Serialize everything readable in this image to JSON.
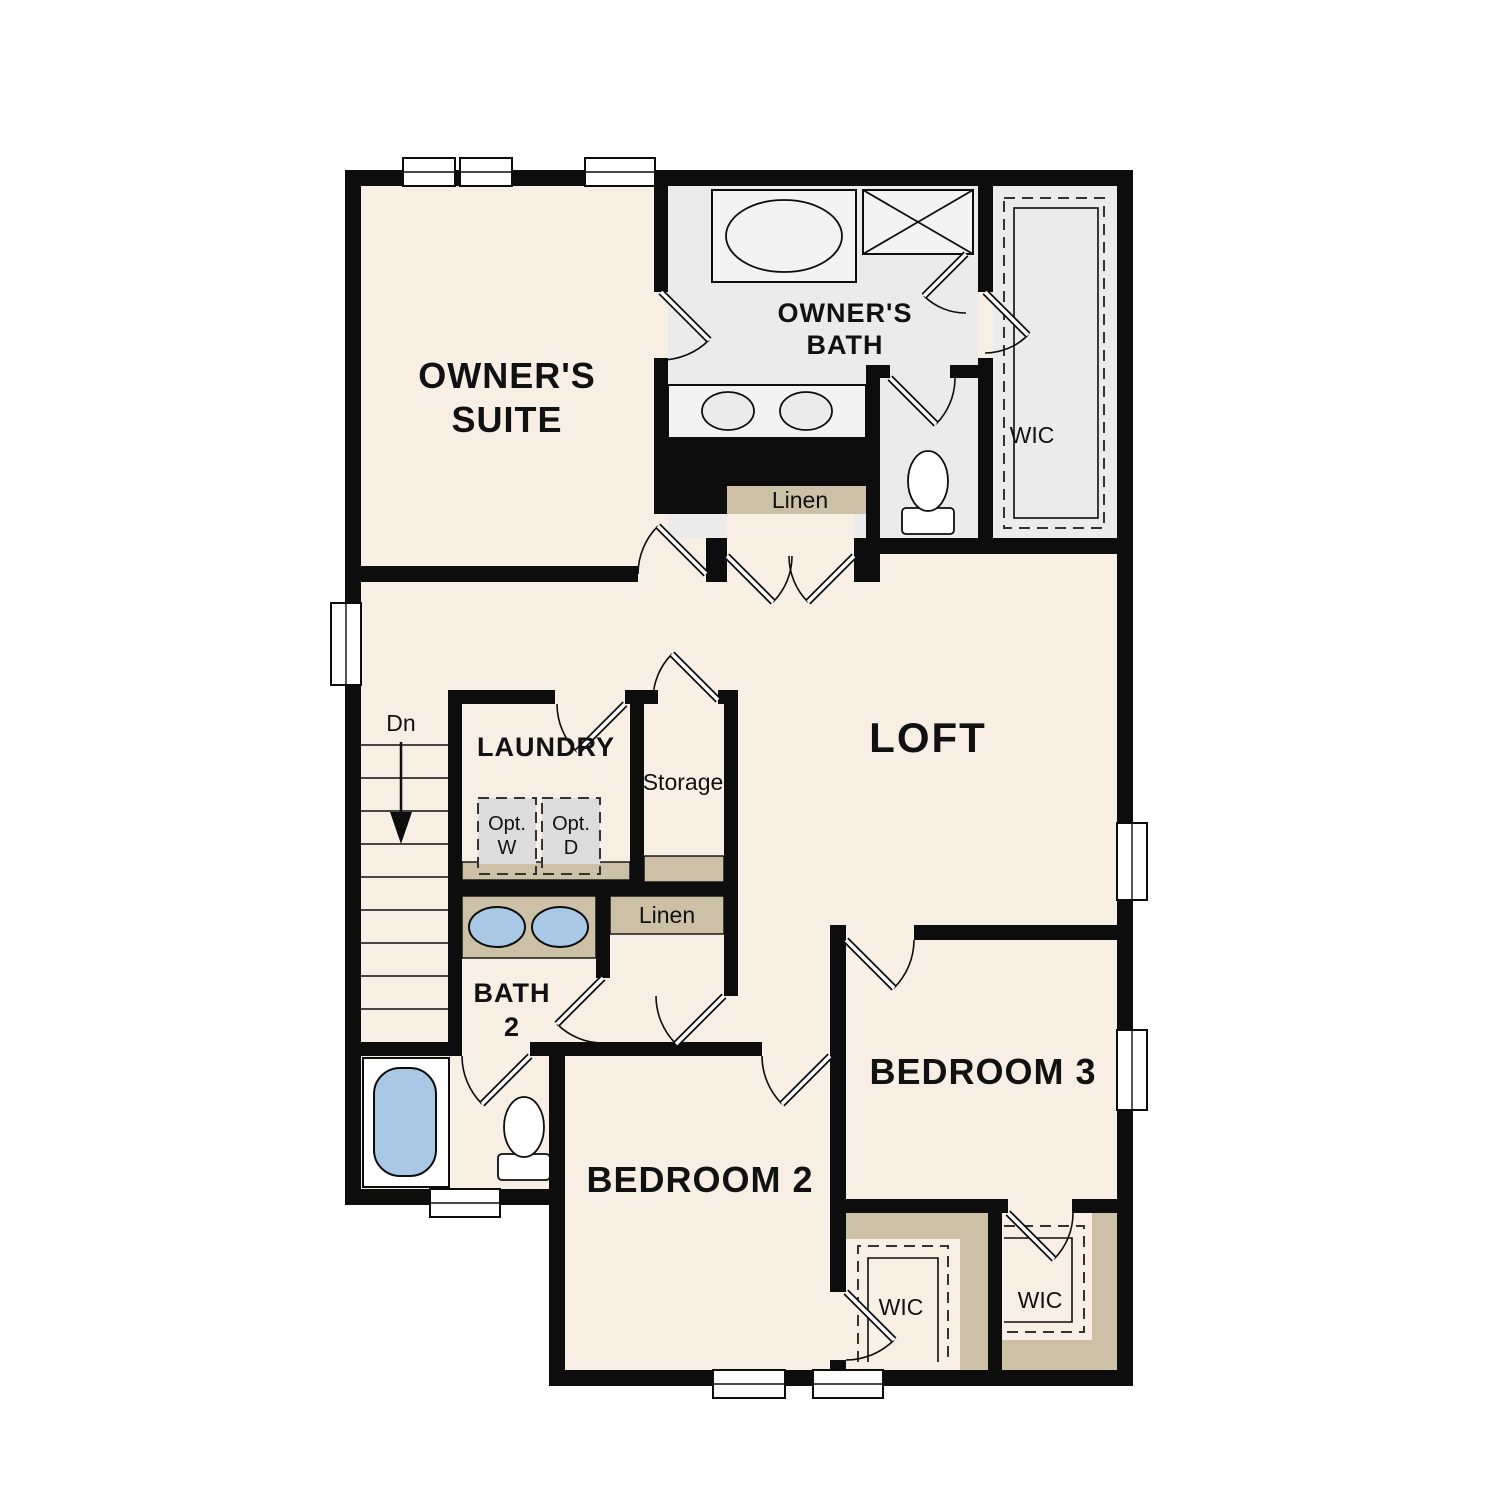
{
  "plan_title": "Second Floor Plan",
  "colors": {
    "wall": "#0d0d0d",
    "room_fill": "#f8efe4",
    "bath_fill": "#ebebeb",
    "closet_fill": "#ebebeb",
    "shelf_tan": "#ccc0a6",
    "fixture_blue": "#a9c8e6",
    "optional_gray": "#dcdcdc",
    "background": "#ffffff"
  },
  "rooms": {
    "owners_suite": {
      "line1": "OWNER'S",
      "line2": "SUITE"
    },
    "owners_bath": {
      "line1": "OWNER'S",
      "line2": "BATH"
    },
    "wic_owners": {
      "label": "WIC"
    },
    "linen_upper": {
      "label": "Linen"
    },
    "loft": {
      "label": "LOFT"
    },
    "stairs": {
      "label": "Dn"
    },
    "laundry": {
      "label": "LAUNDRY"
    },
    "storage": {
      "label": "Storage"
    },
    "opt_washer": {
      "line1": "Opt.",
      "line2": "W"
    },
    "opt_dryer": {
      "line1": "Opt.",
      "line2": "D"
    },
    "linen_lower": {
      "label": "Linen"
    },
    "bath2": {
      "line1": "BATH",
      "line2": "2"
    },
    "bedroom2": {
      "label": "BEDROOM 2"
    },
    "bedroom3": {
      "label": "BEDROOM 3"
    },
    "wic_bedroom2": {
      "label": "WIC"
    },
    "wic_bedroom3": {
      "label": "WIC"
    }
  }
}
